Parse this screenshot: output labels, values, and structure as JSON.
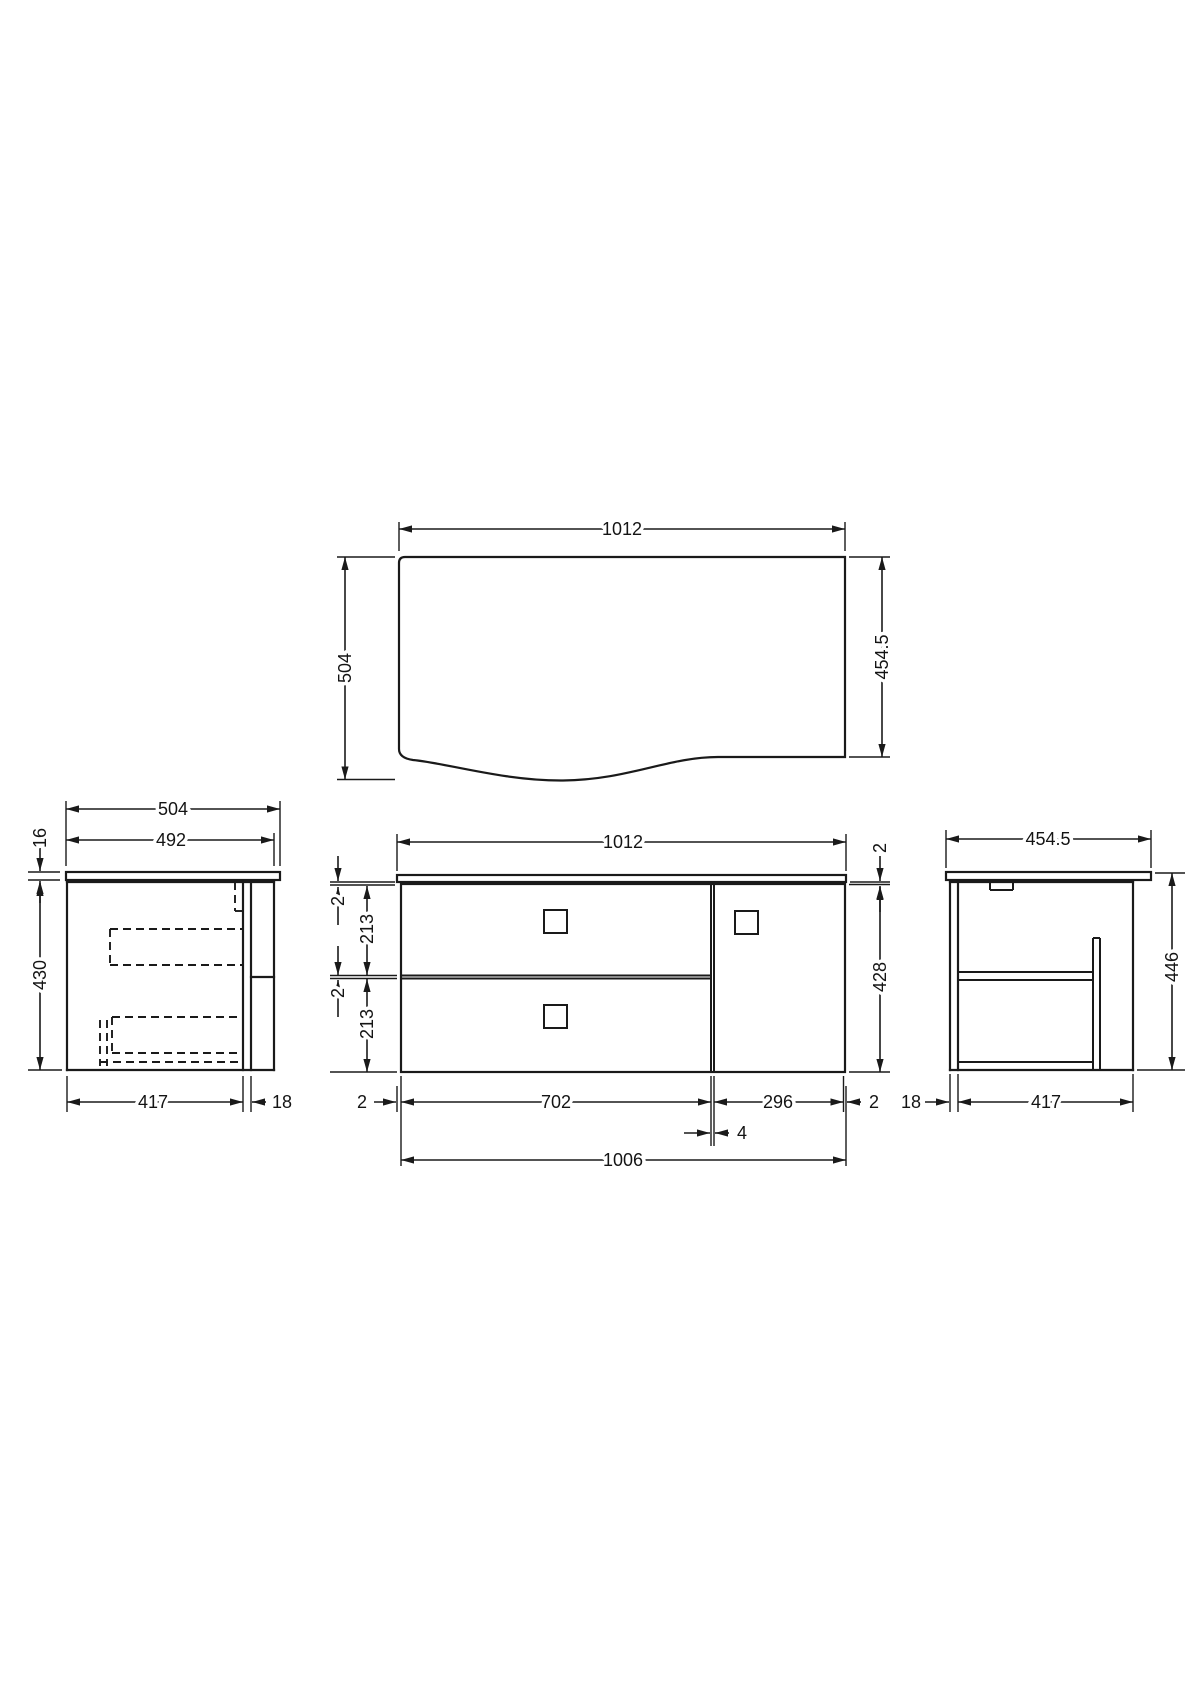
{
  "drawing": {
    "description": "Wall-hung vanity unit technical drawing with four orthographic views",
    "line_color": "#1a1a1a",
    "views": {
      "plan": {
        "width": "1012",
        "depth_left": "504",
        "depth_right": "454.5"
      },
      "side_left": {
        "overall_depth": "504",
        "top_depth": "492",
        "worktop_thickness": "16",
        "cabinet_height": "430",
        "carcass_depth": "417",
        "front_thickness": "18"
      },
      "front": {
        "overall_width": "1012",
        "top_gap": "2",
        "drawer_one_height": "213",
        "drawer_gap": "2",
        "drawer_two_height": "213",
        "right_top_gap": "2",
        "cabinet_height": "428",
        "bottom_left_gap": "2",
        "drawer_section_width": "702",
        "door_section_width": "296",
        "bottom_right_gap": "2",
        "divider_width": "4",
        "cabinet_width": "1006"
      },
      "side_right": {
        "overall_depth": "454.5",
        "cabinet_height": "446",
        "back_thickness": "18",
        "carcass_depth": "417"
      }
    }
  }
}
